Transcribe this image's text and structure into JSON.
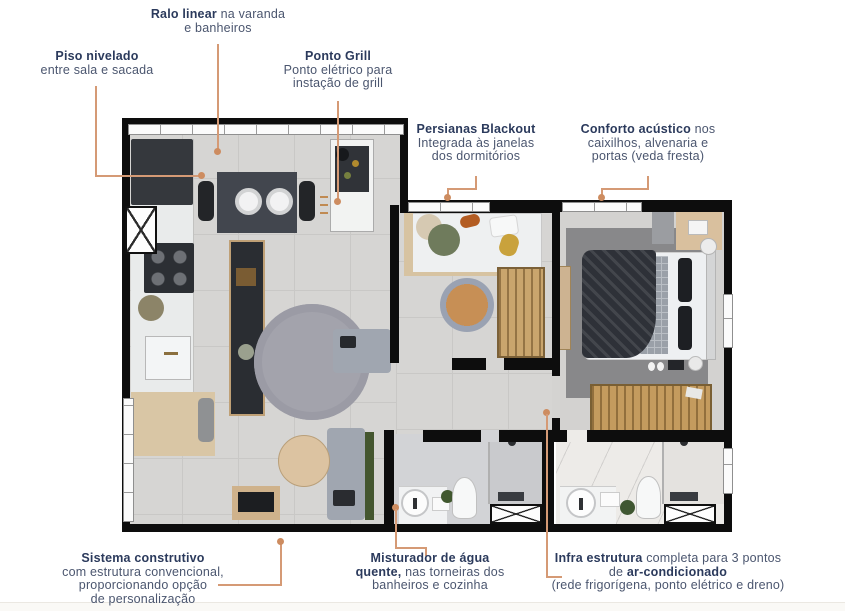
{
  "colors": {
    "label_bold": "#2b3a5c",
    "label_regular": "#4b566f",
    "leader_line": "#d59a75",
    "wall": "#0d0d0d",
    "floor": "#d6d5d3"
  },
  "callouts": {
    "ralo_linear": {
      "bold": "Ralo linear",
      "text": " na varanda",
      "line2": "e banheiros"
    },
    "piso_nivelado": {
      "bold": "Piso nivelado",
      "line2": "entre sala e sacada"
    },
    "ponto_grill": {
      "bold": "Ponto Grill",
      "line2": "Ponto elétrico para",
      "line3": "instação de grill"
    },
    "persianas_blackout": {
      "bold": "Persianas Blackout",
      "line2": "Integrada às janelas",
      "line3": "dos dormitórios"
    },
    "conforto_acustico": {
      "bold": "Conforto acústico",
      "text": " nos",
      "line2": "caixilhos, alvenaria e",
      "line3": "portas (veda fresta)"
    },
    "sistema_construtivo": {
      "bold": "Sistema construtivo",
      "line2": "com estrutura convencional,",
      "line3": "proporcionando opção",
      "line4": "de personalização"
    },
    "misturador": {
      "bold": "Misturador de água",
      "bold2": "quente,",
      "text2": " nas torneiras dos",
      "line3": "banheiros e cozinha"
    },
    "infra_estrutura": {
      "bold": "Infra estrutura",
      "text": " completa para 3 pontos",
      "line2_pre": "de ",
      "line2_bold": "ar-condicionado",
      "line3": "(rede frigorígena, ponto elétrico e dreno)"
    }
  }
}
